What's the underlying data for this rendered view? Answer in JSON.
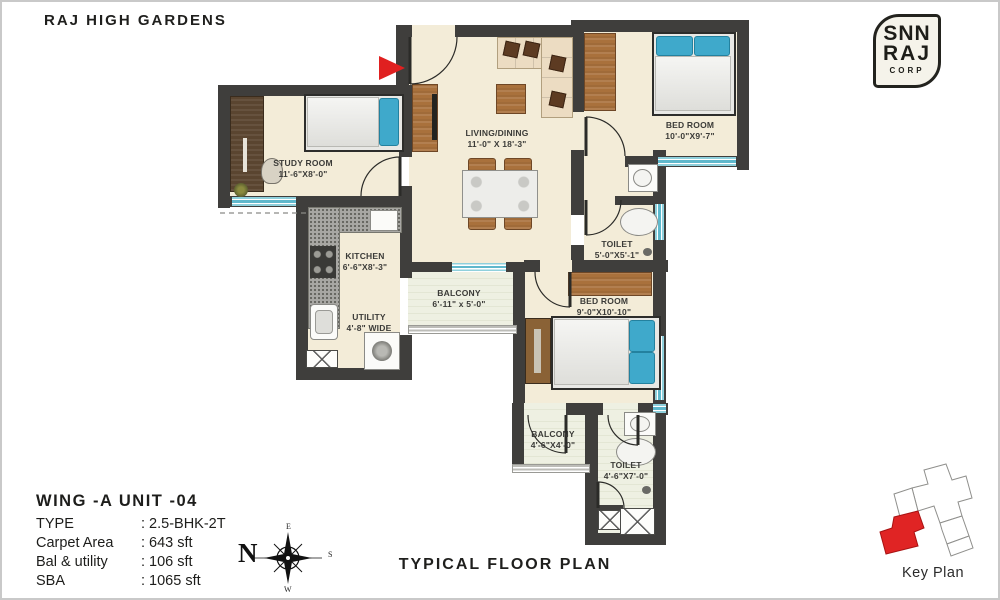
{
  "header": {
    "title": "RAJ HIGH GARDENS"
  },
  "logo": {
    "line1": "SNN",
    "line2": "RAJ",
    "sub": "CORP"
  },
  "plan": {
    "rooms": [
      {
        "id": "study",
        "name": "STUDY ROOM",
        "dim": "11'-6\"X8'-0\""
      },
      {
        "id": "living",
        "name": "LIVING/DINING",
        "dim": "11'-0\" X 18'-3\""
      },
      {
        "id": "bed1",
        "name": "BED ROOM",
        "dim": "10'-0\"X9'-7\""
      },
      {
        "id": "toilet1",
        "name": "TOILET",
        "dim": "5'-0\"X5'-1\""
      },
      {
        "id": "kitchen",
        "name": "KITCHEN",
        "dim": "6'-6\"X8'-3\""
      },
      {
        "id": "utility",
        "name": "UTILITY",
        "dim": "4'-8\" WIDE"
      },
      {
        "id": "balcony1",
        "name": "BALCONY",
        "dim": "6'-11\" x 5'-0\""
      },
      {
        "id": "bed2",
        "name": "BED ROOM",
        "dim": "9'-0\"X10'-10\""
      },
      {
        "id": "balcony2",
        "name": "BALCONY",
        "dim": "4'-6\"X4'-0\""
      },
      {
        "id": "toilet2",
        "name": "TOILET",
        "dim": "4'-6\"X7'-0\""
      }
    ]
  },
  "unit_info": {
    "heading": "WING -A  UNIT -04",
    "rows": [
      {
        "label": "TYPE",
        "value": ": 2.5-BHK-2T"
      },
      {
        "label": "Carpet Area",
        "value": ": 643 sft"
      },
      {
        "label": "Bal & utility",
        "value": ": 106 sft"
      },
      {
        "label": "SBA",
        "value": ": 1065 sft"
      }
    ]
  },
  "compass": {
    "north": "N",
    "east": "E",
    "south": "S",
    "west": "W"
  },
  "footer": {
    "plan_title": "TYPICAL FLOOR PLAN",
    "key_plan_label": "Key Plan"
  },
  "colors": {
    "accent_red": "#e02020",
    "wall": "#3f3e3c",
    "floor": "#f3ecd8",
    "window": "#5fb8cc",
    "wood": "#a9713c"
  }
}
